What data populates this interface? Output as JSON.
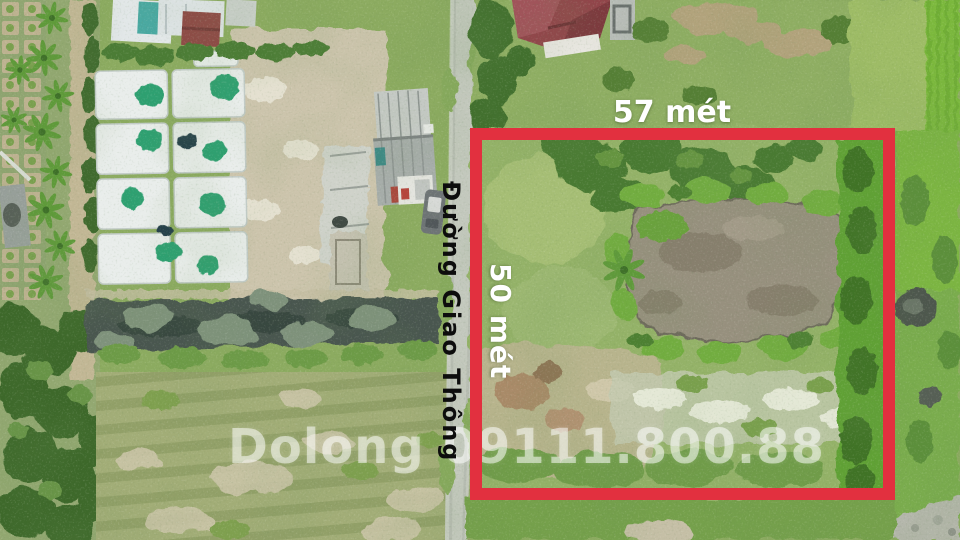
{
  "annotations": {
    "width_label": "57 mét",
    "height_label": "50 mét",
    "road_label": "Đường Giao Thông",
    "watermark": "Dolong 09111.800.88"
  },
  "colors": {
    "boundary_red": "#e2303f",
    "label_white": "#ffffff",
    "road_label_black": "#0d0d0d",
    "road_grey": "#b7bcb2",
    "pond_brown": "#97907e",
    "canal_dark": "#49564f",
    "field_green": "#a2ad77"
  }
}
